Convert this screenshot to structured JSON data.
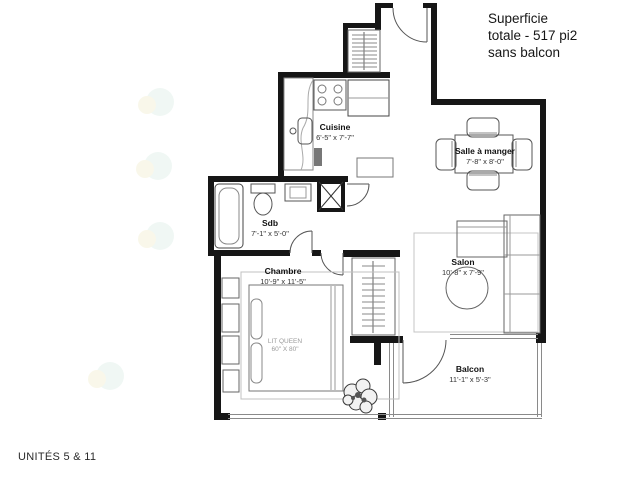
{
  "title": {
    "line1": "Superficie",
    "line2": "totale - 517 pi2",
    "line3": "sans balcon"
  },
  "footer": {
    "units_label": "UNITÉS 5 & 11"
  },
  "rooms": {
    "cuisine": {
      "name": "Cuisine",
      "dims": "6'-5\" x 7'-7\""
    },
    "salle_a_manger": {
      "name": "Salle à manger",
      "dims": "7'-8\" x 8'-0\""
    },
    "sdb": {
      "name": "Sdb",
      "dims": "7'-1\" x 5'-0\""
    },
    "chambre": {
      "name": "Chambre",
      "dims": "10'-9\" x 11'-5\""
    },
    "salon": {
      "name": "Salon",
      "dims": "10'-8\" x 7'-9\""
    },
    "balcon": {
      "name": "Balcon",
      "dims": "11'-1\" x 5'-3\""
    }
  },
  "furniture": {
    "bed_label_line1": "LIT QUEEN",
    "bed_label_line2": "60\" X 80\""
  },
  "colors": {
    "wall": "#161616",
    "furniture_line": "#666666",
    "thin_line": "#aaaaaa",
    "text": "#1a1a1a"
  }
}
